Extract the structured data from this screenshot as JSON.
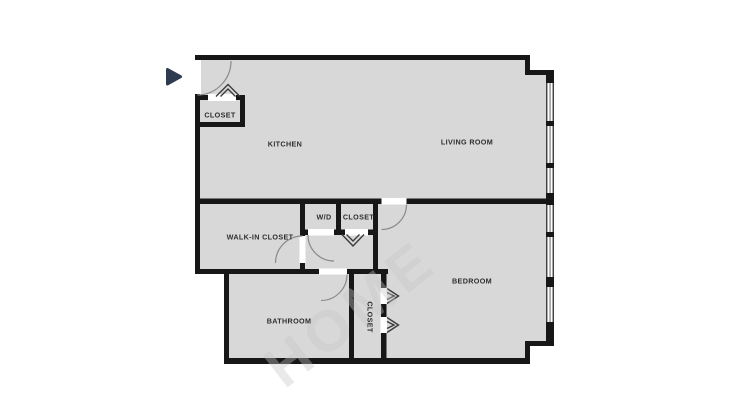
{
  "rooms": {
    "entry_closet": "CLOSET",
    "kitchen": "KITCHEN",
    "living_room": "LIVING ROOM",
    "wd": "W/D",
    "hall_closet": "CLOSET",
    "walk_in_closet": "WALK-IN CLOSET",
    "bedroom": "BEDROOM",
    "bathroom": "BATHROOM",
    "bedroom_closet": "CLOSET"
  },
  "watermark": "HOME",
  "icons": {
    "entry_arrow": "right-pointing-triangle"
  },
  "colors": {
    "background": "#ffffff",
    "floor": "#d8d8d8",
    "wall": "#171717",
    "door_arc": "#8a8a8a",
    "window_line": "#555555",
    "chevron": "#3c3c3c",
    "label": "#2e2e2e",
    "entry_arrow": "#2e3b50",
    "watermark": "#c8c8c8"
  }
}
